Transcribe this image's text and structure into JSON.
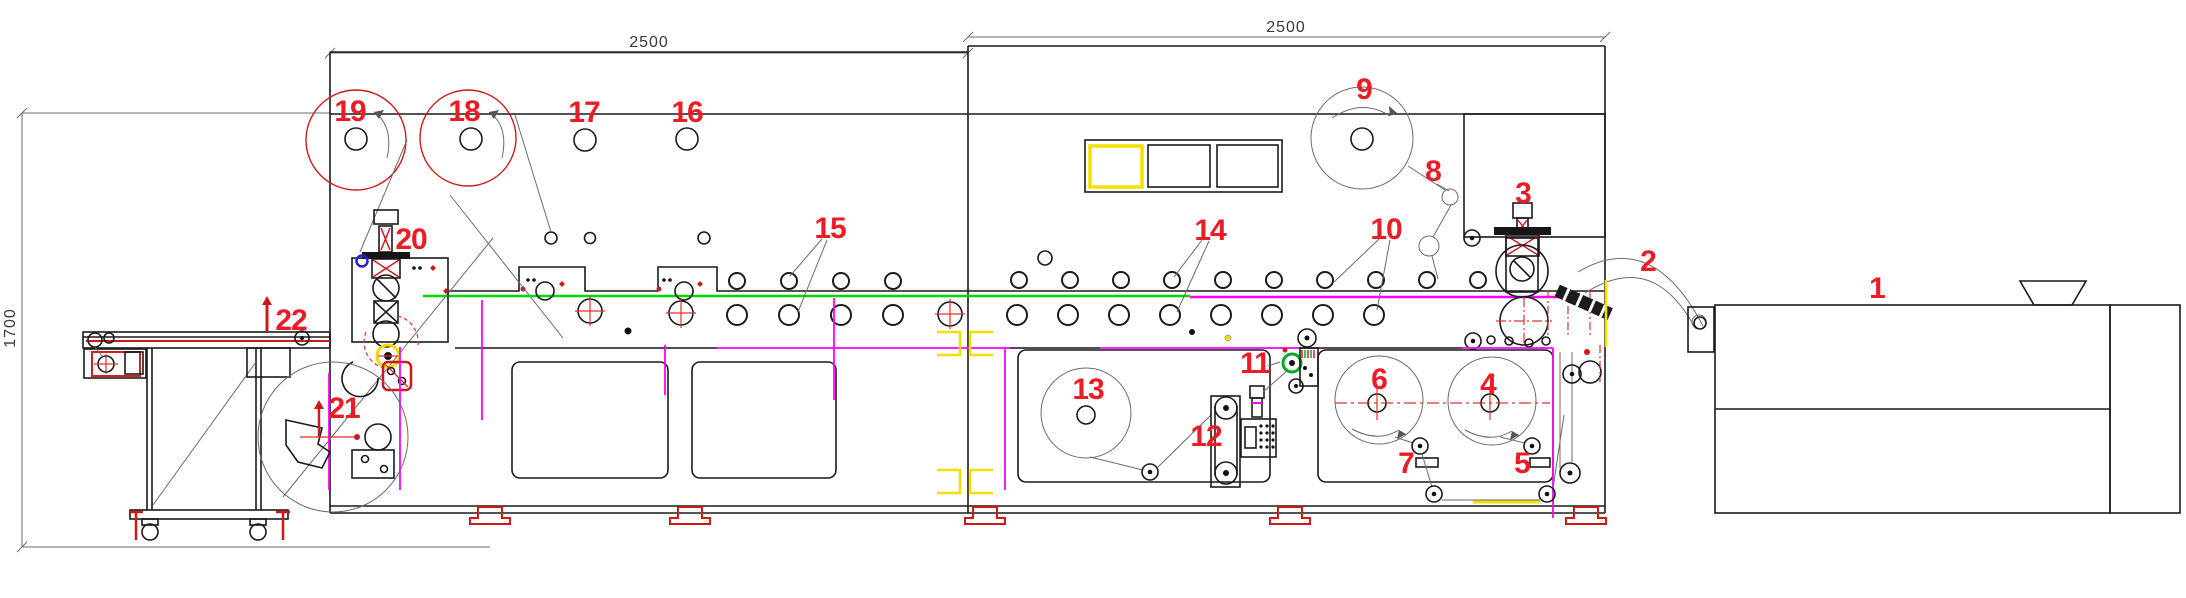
{
  "drawing": {
    "type": "machine-line elevation drawing",
    "dimensions": {
      "left_module_width": "2500",
      "right_module_width": "2500",
      "infeed_height": "1700"
    },
    "callouts": {
      "c1": "1",
      "c2": "2",
      "c3": "3",
      "c4": "4",
      "c5": "5",
      "c6": "6",
      "c7": "7",
      "c8": "8",
      "c9": "9",
      "c10": "10",
      "c11": "11",
      "c12": "12",
      "c13": "13",
      "c14": "14",
      "c15": "15",
      "c16": "16",
      "c17": "17",
      "c18": "18",
      "c19": "19",
      "c20": "20",
      "c21": "21",
      "c22": "22"
    },
    "colors": {
      "callout_red": "#ec1c24",
      "web_green": "#00d800",
      "web_magenta": "#ff00ff",
      "highlight_yellow": "#f2e000",
      "accent_blue": "#2424cc",
      "line_black": "#1a1a1a",
      "dim_text": "#3a3a3a"
    }
  }
}
